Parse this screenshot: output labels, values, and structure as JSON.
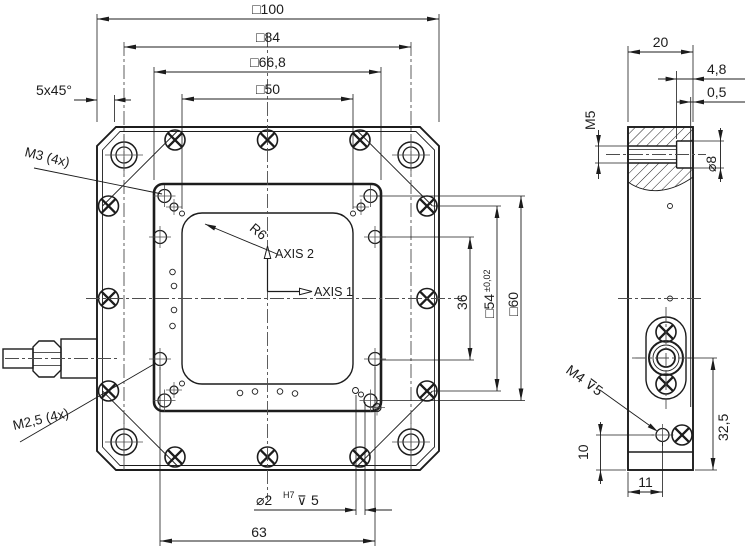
{
  "front_view": {
    "dim_outer": "□100",
    "dim_bolt_pattern": "□84",
    "dim_plate": "□66,8",
    "dim_aperture": "□50",
    "dim_chamfer": "5x45°",
    "label_m3": "M3 (4x)",
    "label_m2_5": "M2,5 (4x)",
    "label_radius": "R6",
    "label_axis_1": "AXIS 1",
    "label_axis_2": "AXIS 2",
    "dim_36": "36",
    "dim_54": "□54",
    "dim_54_tolerance": "±0,02",
    "dim_60": "□60",
    "dim_dowel_dia": "⌀2",
    "dim_dowel_fit": "H7",
    "dim_dowel_depth_symbol": "⊽",
    "dim_dowel_depth": "5",
    "dim_63": "63"
  },
  "side_view": {
    "dim_width": "20",
    "dim_counterbore_depth": "4,8",
    "dim_cover": "0,5",
    "label_m5": "M5",
    "dim_bore_dia": "⌀8",
    "label_m4": "M4 ⊽5",
    "dim_32_5": "32,5",
    "dim_10": "10",
    "dim_11": "11"
  },
  "colors": {
    "line": "#1c1c1c",
    "centerline": "#4d4d4d",
    "background": "#ffffff"
  }
}
